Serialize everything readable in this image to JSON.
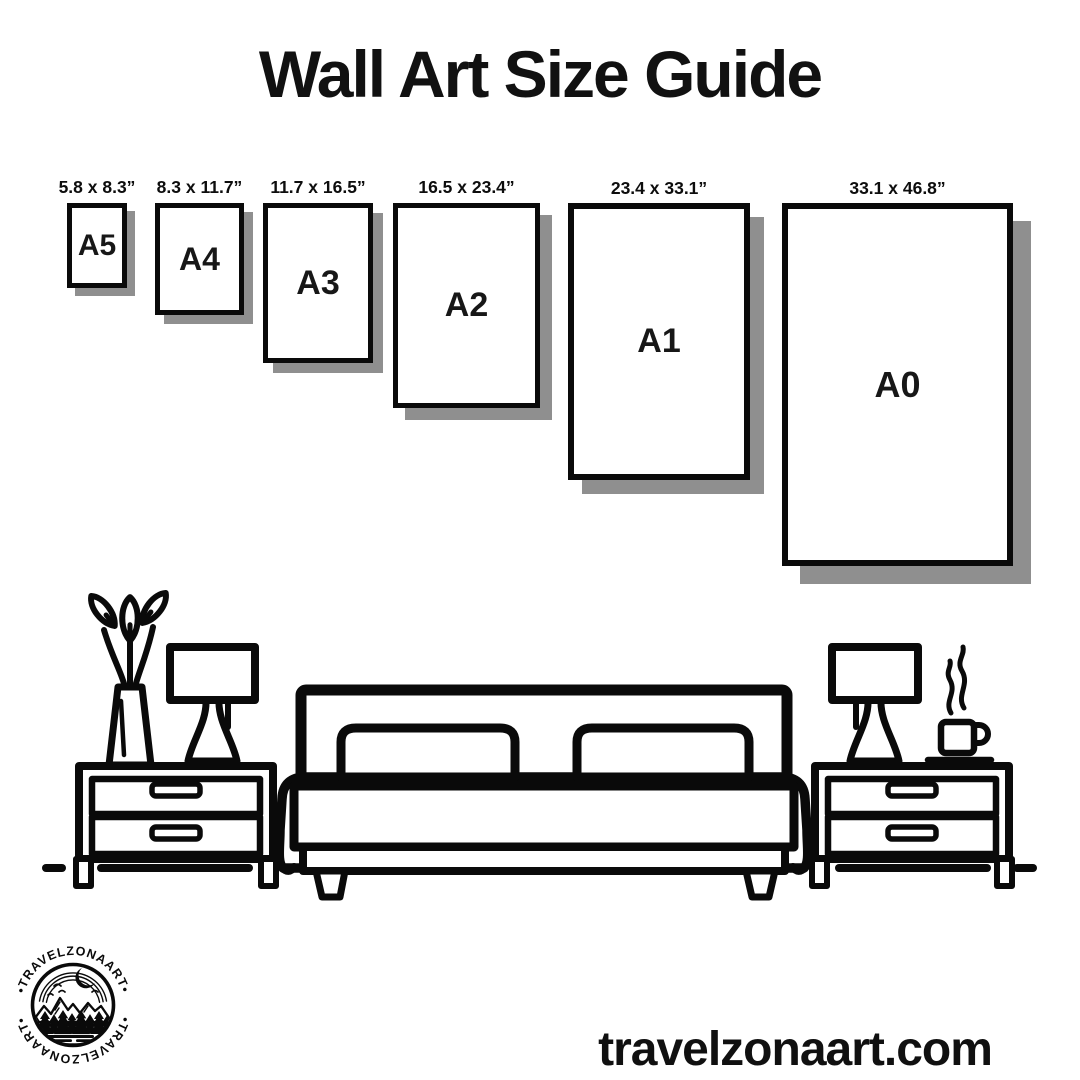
{
  "title": "Wall Art Size Guide",
  "sizes": [
    {
      "code": "A5",
      "dimensions": "5.8 x 8.3”"
    },
    {
      "code": "A4",
      "dimensions": "8.3 x 11.7”"
    },
    {
      "code": "A3",
      "dimensions": "11.7 x 16.5”"
    },
    {
      "code": "A2",
      "dimensions": "16.5 x 23.4”"
    },
    {
      "code": "A1",
      "dimensions": "23.4 x 33.1”"
    },
    {
      "code": "A0",
      "dimensions": "33.1 x 46.8”"
    }
  ],
  "scene": {
    "description": "black line-art bedroom: double bed with two pillows, two nightstands with drawers, two table lamps, vase with plant, steaming coffee cup on saucer",
    "objects": [
      "vase-with-plant",
      "table-lamp",
      "nightstand",
      "double-bed",
      "nightstand",
      "table-lamp",
      "coffee-cup"
    ]
  },
  "logo": {
    "ring_text": "•TRAVELZONAART•"
  },
  "footer": {
    "website": "travelzonaart.com"
  },
  "colors": {
    "ink": "#0a0a0a",
    "shadow": "#8f8f8f",
    "background": "#ffffff"
  }
}
